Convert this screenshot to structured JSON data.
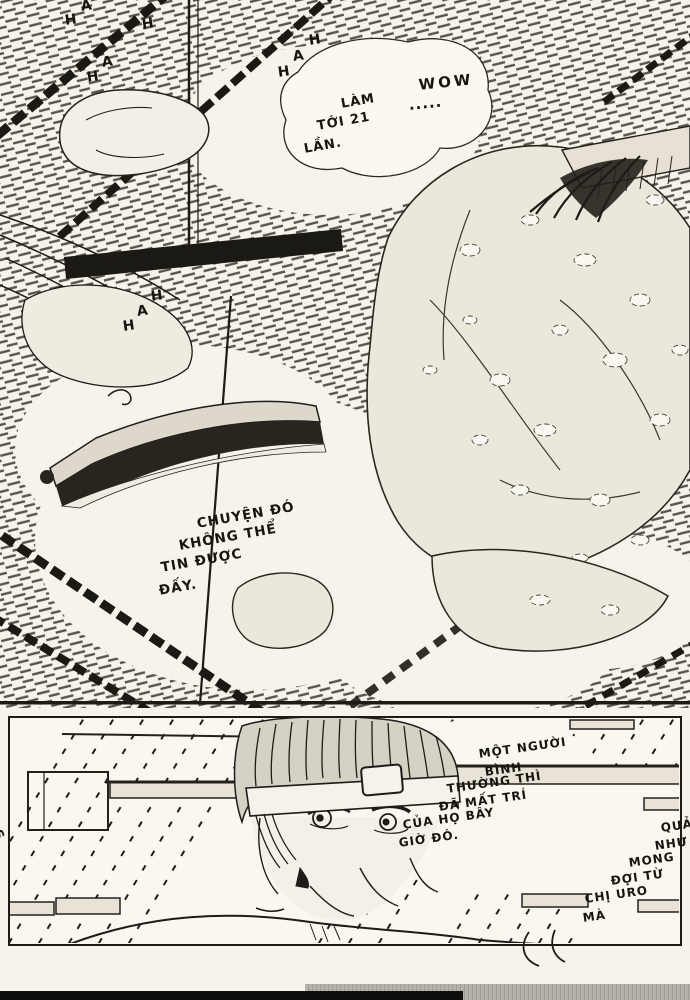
{
  "colors": {
    "paper": "#f7f3ea",
    "ink": "#1e1b16",
    "tone": "#2a2722",
    "strip_black": "#0f0e0c",
    "strip_gray": "#b3afa7"
  },
  "panel1": {
    "bubble_wow": {
      "lines": [
        "WOW",
        ".....",
        "LÀM",
        "TỚI 21",
        "LẦN."
      ]
    },
    "caption": {
      "lines": [
        "CHUYỆN ĐÓ",
        "KHÔNG THỂ",
        "TIN ĐƯỢC",
        "ĐẤY."
      ]
    },
    "sfx_top_left": [
      "A",
      "H",
      "H",
      "A",
      "H"
    ],
    "sfx_top_mid": [
      "H",
      "A",
      "H"
    ],
    "sfx_mid_left": [
      "H",
      "A",
      "H"
    ]
  },
  "panel2": {
    "bubble_normal_person": {
      "lines": [
        "MỘT NGƯỜI",
        "BÌNH",
        "THƯỜNG THÌ",
        "ĐÃ MẤT TRÍ",
        "CỦA HỌ BÂY",
        "GIỜ ĐÓ."
      ]
    },
    "bubble_as_expected": {
      "lines": [
        "QUẢ",
        "NHƯ",
        "MONG",
        "ĐỢI TỪ",
        "CHỊ URO",
        "MÀ"
      ]
    },
    "sfx_edge": "S"
  }
}
